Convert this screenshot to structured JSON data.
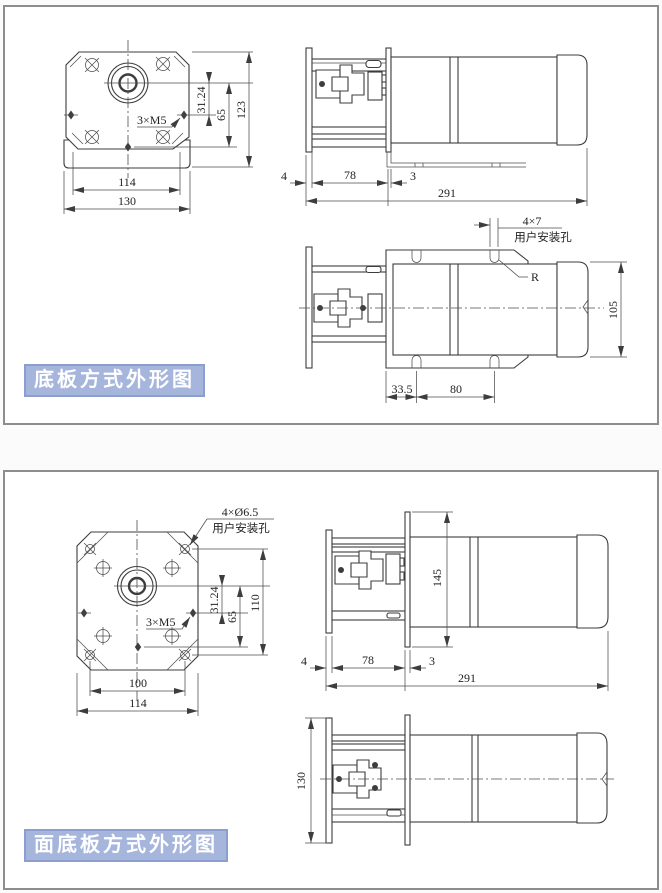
{
  "colors": {
    "label_bg": "#a6b5db",
    "label_border": "#8b9ecf",
    "label_text": "#ffffff",
    "line": "#3d3d3d",
    "panel_border": "#8d8d8d"
  },
  "panel1": {
    "label": "底板方式外形图",
    "front": {
      "thread": "3×M5",
      "dim_offset": "31.24",
      "dim_65": "65",
      "dim_height": "123",
      "dim_114": "114",
      "dim_130": "130"
    },
    "side": {
      "dim_4": "4",
      "dim_78": "78",
      "dim_3": "3",
      "dim_291": "291"
    },
    "top": {
      "callout_size": "4×7",
      "callout_text": "用户安装孔",
      "radius": "R",
      "dim_105": "105",
      "dim_33_5": "33.5",
      "dim_80": "80"
    }
  },
  "panel2": {
    "label": "面底板方式外形图",
    "front": {
      "callout_size": "4×Ø6.5",
      "callout_text": "用户安装孔",
      "thread": "3×M5",
      "dim_offset": "31.24",
      "dim_65": "65",
      "dim_110": "110",
      "dim_100": "100",
      "dim_114": "114"
    },
    "side": {
      "dim_145": "145",
      "dim_4": "4",
      "dim_78": "78",
      "dim_3": "3",
      "dim_291": "291"
    },
    "top": {
      "dim_130": "130"
    }
  }
}
